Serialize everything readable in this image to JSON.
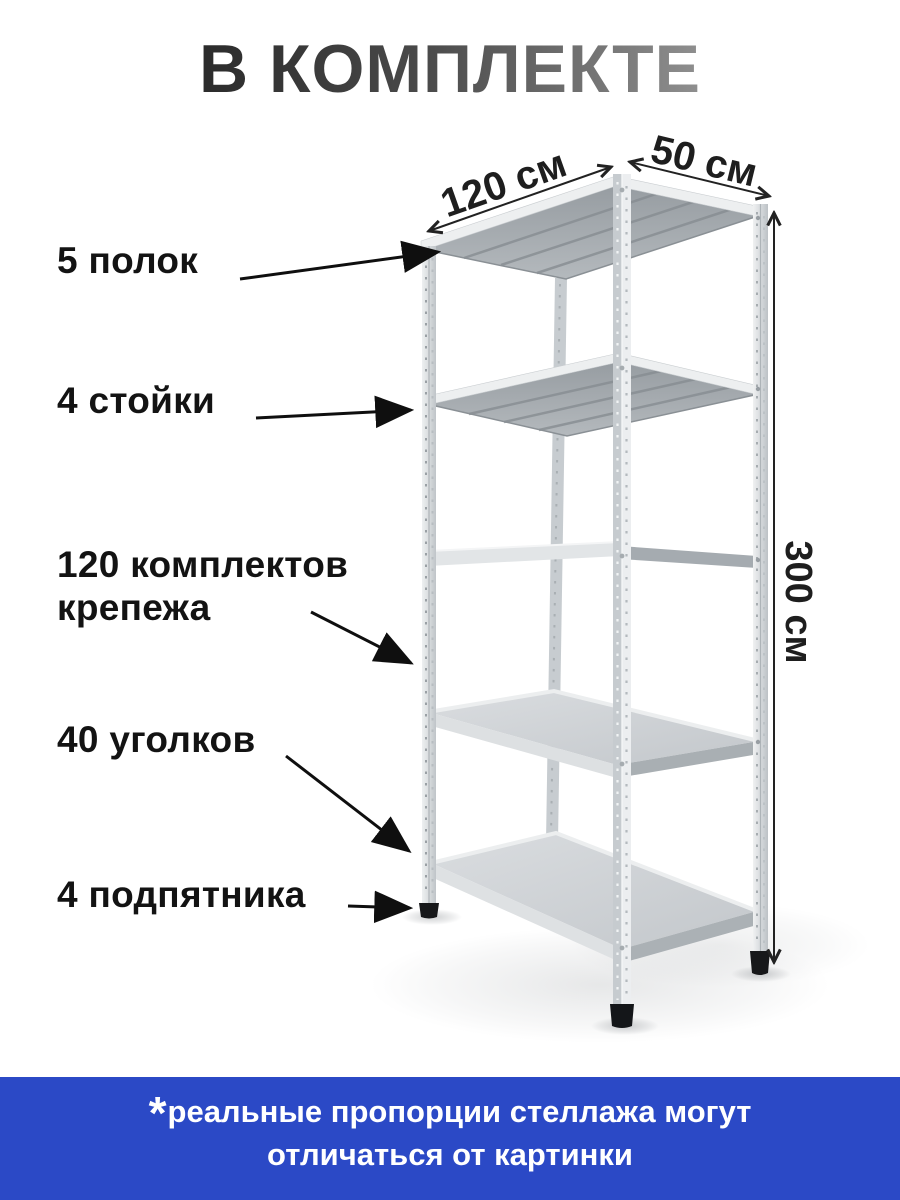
{
  "title": "В КОМПЛЕКТЕ",
  "dimensions": {
    "width_label": "120 см",
    "depth_label": "50 см",
    "height_label": "300 см"
  },
  "callouts": [
    {
      "label": "5 полок"
    },
    {
      "label": "4 стойки"
    },
    {
      "label": "120 комплектов крепежа"
    },
    {
      "label": "40 уголков"
    },
    {
      "label": "4 подпятника"
    }
  ],
  "footnote": {
    "asterisk": "*",
    "text": "реальные пропорции стеллажа могут отличаться от картинки"
  },
  "colors": {
    "banner_blue": "#2b49c6",
    "title_gradient_start": "#2b2b2b",
    "title_gradient_end": "#8f8f8f",
    "arrow_black": "#111111",
    "metal_light": "#eceef0",
    "metal_mid": "#cdd1d4",
    "metal_dark": "#a2a8ad",
    "foot_black": "#17181a"
  }
}
